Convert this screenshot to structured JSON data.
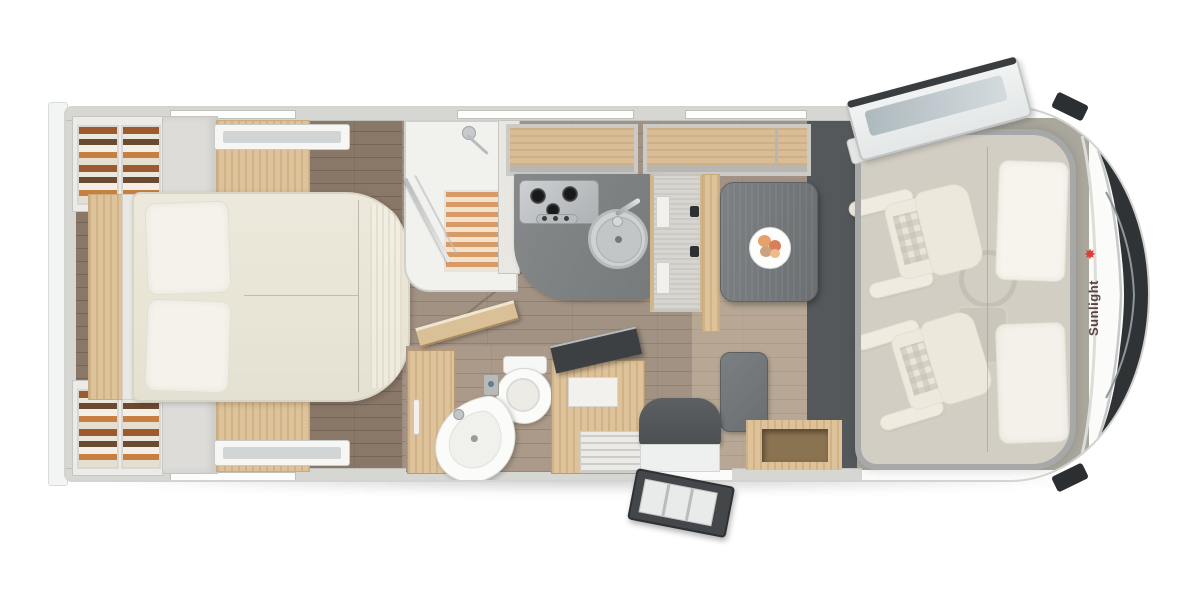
{
  "brand": {
    "name": "Sunlight",
    "logo_text_color": "#5b4343",
    "logo_icon": "sun-icon",
    "logo_icon_color": "#e03c31"
  },
  "floorplan": {
    "type": "motorhome-top-view",
    "orientation": "front-of-vehicle-right",
    "areas": [
      {
        "id": "rear-bedroom",
        "furniture": [
          "island-double-bed",
          "two-pillows",
          "headboard-shelf",
          "wardrobe-top-left-with-clothes",
          "wardrobe-bottom-left-with-clothes",
          "bedside-cabinets",
          "roof-vents"
        ]
      },
      {
        "id": "shower-room",
        "furniture": [
          "shower-tray",
          "wooden-slat-mat",
          "glass-door",
          "shower-fixture"
        ]
      },
      {
        "id": "washroom",
        "furniture": [
          "toilet",
          "corner-washbasin",
          "vanity-cabinet",
          "open-door"
        ]
      },
      {
        "id": "kitchen",
        "furniture": [
          "l-shaped-worktop",
          "three-burner-gas-hob",
          "round-sink-with-faucet",
          "tall-fridge",
          "overhead-lockers"
        ]
      },
      {
        "id": "dinette",
        "furniture": [
          "table-with-plate-of-food",
          "side-bench-seat",
          "storage-cabinet-open-lid",
          "bench-wood-base"
        ]
      },
      {
        "id": "entrance",
        "furniture": [
          "entry-step",
          "open-entry-door-with-steps",
          "seat-backrest"
        ]
      },
      {
        "id": "cab",
        "furniture": [
          "driver-seat-swivel",
          "passenger-seat-swivel",
          "steering-wheel",
          "center-console",
          "drop-down-bed-overlay",
          "open-skylight",
          "side-mirrors",
          "windshield-with-wipers"
        ]
      }
    ]
  },
  "palette": {
    "background": "#ffffff",
    "body_shell": "#fbfbfa",
    "wall_gray": "#d6d6d3",
    "floor_wood": "#a29283",
    "bedroom_floor": "#897767",
    "furniture_wood": "#ddc29a",
    "worktop_gray": "#7e8283",
    "table_gray": "#73777a",
    "upholstery_cream": "#ece9db",
    "dark_accent": "#54585a",
    "windshield": "#2f3335"
  }
}
